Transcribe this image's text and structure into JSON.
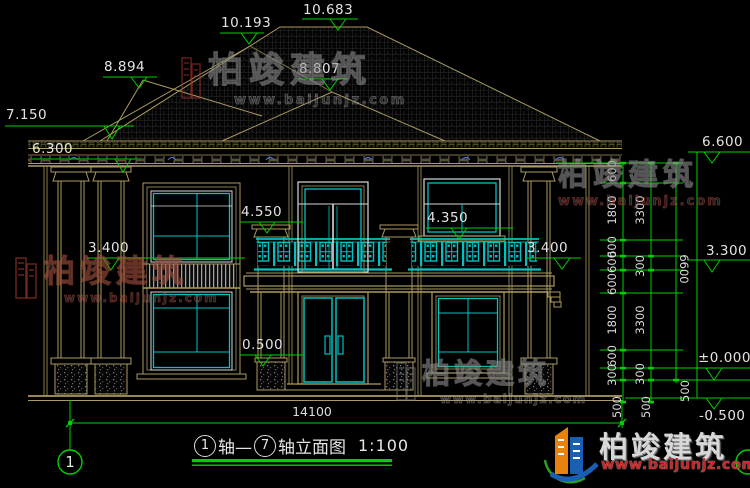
{
  "title_block": {
    "axis_a": "1",
    "axis_text_a": "轴—",
    "axis_b": "7",
    "axis_text_b": "轴立面图",
    "scale": "1:100",
    "axis_bubble_left": "1"
  },
  "dimensions": {
    "overall_width": "14100",
    "right_chain_inner": [
      "600",
      "1800",
      "600",
      "600",
      "600",
      "1800",
      "600",
      "300"
    ],
    "right_chain_mid": [
      "3300",
      "300",
      "3300",
      "300"
    ],
    "right_chain_outer": [
      "6600"
    ],
    "below_datum": [
      "500",
      "500",
      "500"
    ]
  },
  "elevation_markers": {
    "m10683": "10.683",
    "m10193": "10.193",
    "m8894": "8.894",
    "m8807": "8.807",
    "m7150": "7.150",
    "m6300": "6.300",
    "m3400_left": "3.400",
    "m4550": "4.550",
    "m4350": "4.350",
    "m3400_right": "3.400",
    "m0500": "0.500",
    "m6600": "6.600",
    "m3300": "3.300",
    "m0": "±0.000",
    "m_minus500": "-0.500"
  },
  "watermarks": {
    "brand": "柏竣建筑",
    "url": "www.baijunjz.com"
  },
  "footer_logo": {
    "brand": "柏竣建筑",
    "url": "www.baijunjz.com"
  },
  "colors": {
    "line_tan": "#ab9a62",
    "accent_cyan": "#00c2c2",
    "dim_green": "#00cf00",
    "text_white": "#e3e3e3",
    "logo_orange": "#e8820c",
    "logo_blue": "#1b5fb5",
    "logo_red": "#c62828"
  }
}
